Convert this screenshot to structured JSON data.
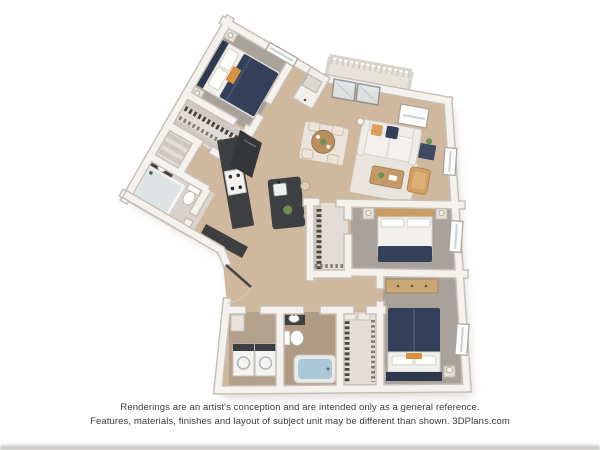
{
  "disclaimer": {
    "line1": "Renderings are an artist's conception and are intended only as a general reference.",
    "line2": "Features, materials, finishes and layout of subject unit may be different than shown. 3DPlans.com"
  },
  "floorplan": {
    "description": "3D top-down rendering of a multi-bedroom apartment unit with angled upper-left wing, living room with balcony, kitchen island, three beds, two baths, laundry and walk-in closets"
  },
  "colors": {
    "wall": "#f5f2ee",
    "wallEdge": "#c6c0b8",
    "wood": "#cfb89d",
    "carpet": "#a8a29b",
    "closetFloor": "#e2ddd6",
    "bathFloor": "#d8d3cc",
    "bathFloor2": "#b09a83",
    "laundryFloor": "#b4a18c",
    "navy": "#344059",
    "navyDark": "#2e3950",
    "bedding": "#f2f0ec",
    "tan": "#c89e66",
    "counter": "#3e3f41",
    "applianceWhite": "#f4f3f1",
    "tub": "#a9c8d8",
    "glass": "#dfe7e9",
    "railing": "#d5d0c9",
    "rug": "#e9e4dd",
    "green": "#6f8f4f",
    "orange": "#d89040",
    "shadow": "#b6b1aa"
  }
}
